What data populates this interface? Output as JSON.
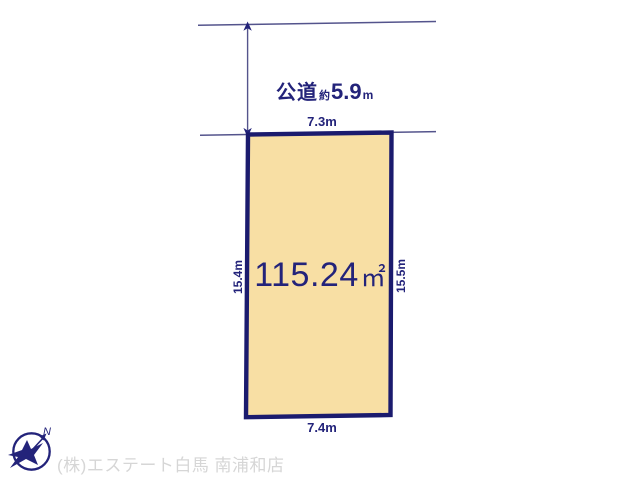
{
  "colors": {
    "navy": "#23237a",
    "plot-fill": "#f8dfa4",
    "plot-border": "#1b1b6e",
    "thin-line": "#54548c",
    "footer-gray": "#d6d6d6"
  },
  "road": {
    "name": "公道",
    "approx_prefix": "約",
    "width_value": "5.9",
    "unit": "m"
  },
  "plot": {
    "area_value": "115.24",
    "area_unit": "㎡",
    "dim_top": "7.3m",
    "dim_bottom": "7.4m",
    "dim_left": "15.4m",
    "dim_right": "15.5m"
  },
  "compass": {
    "north_label": "N"
  },
  "footer": {
    "company": "(株)エステート白馬 南浦和店"
  }
}
